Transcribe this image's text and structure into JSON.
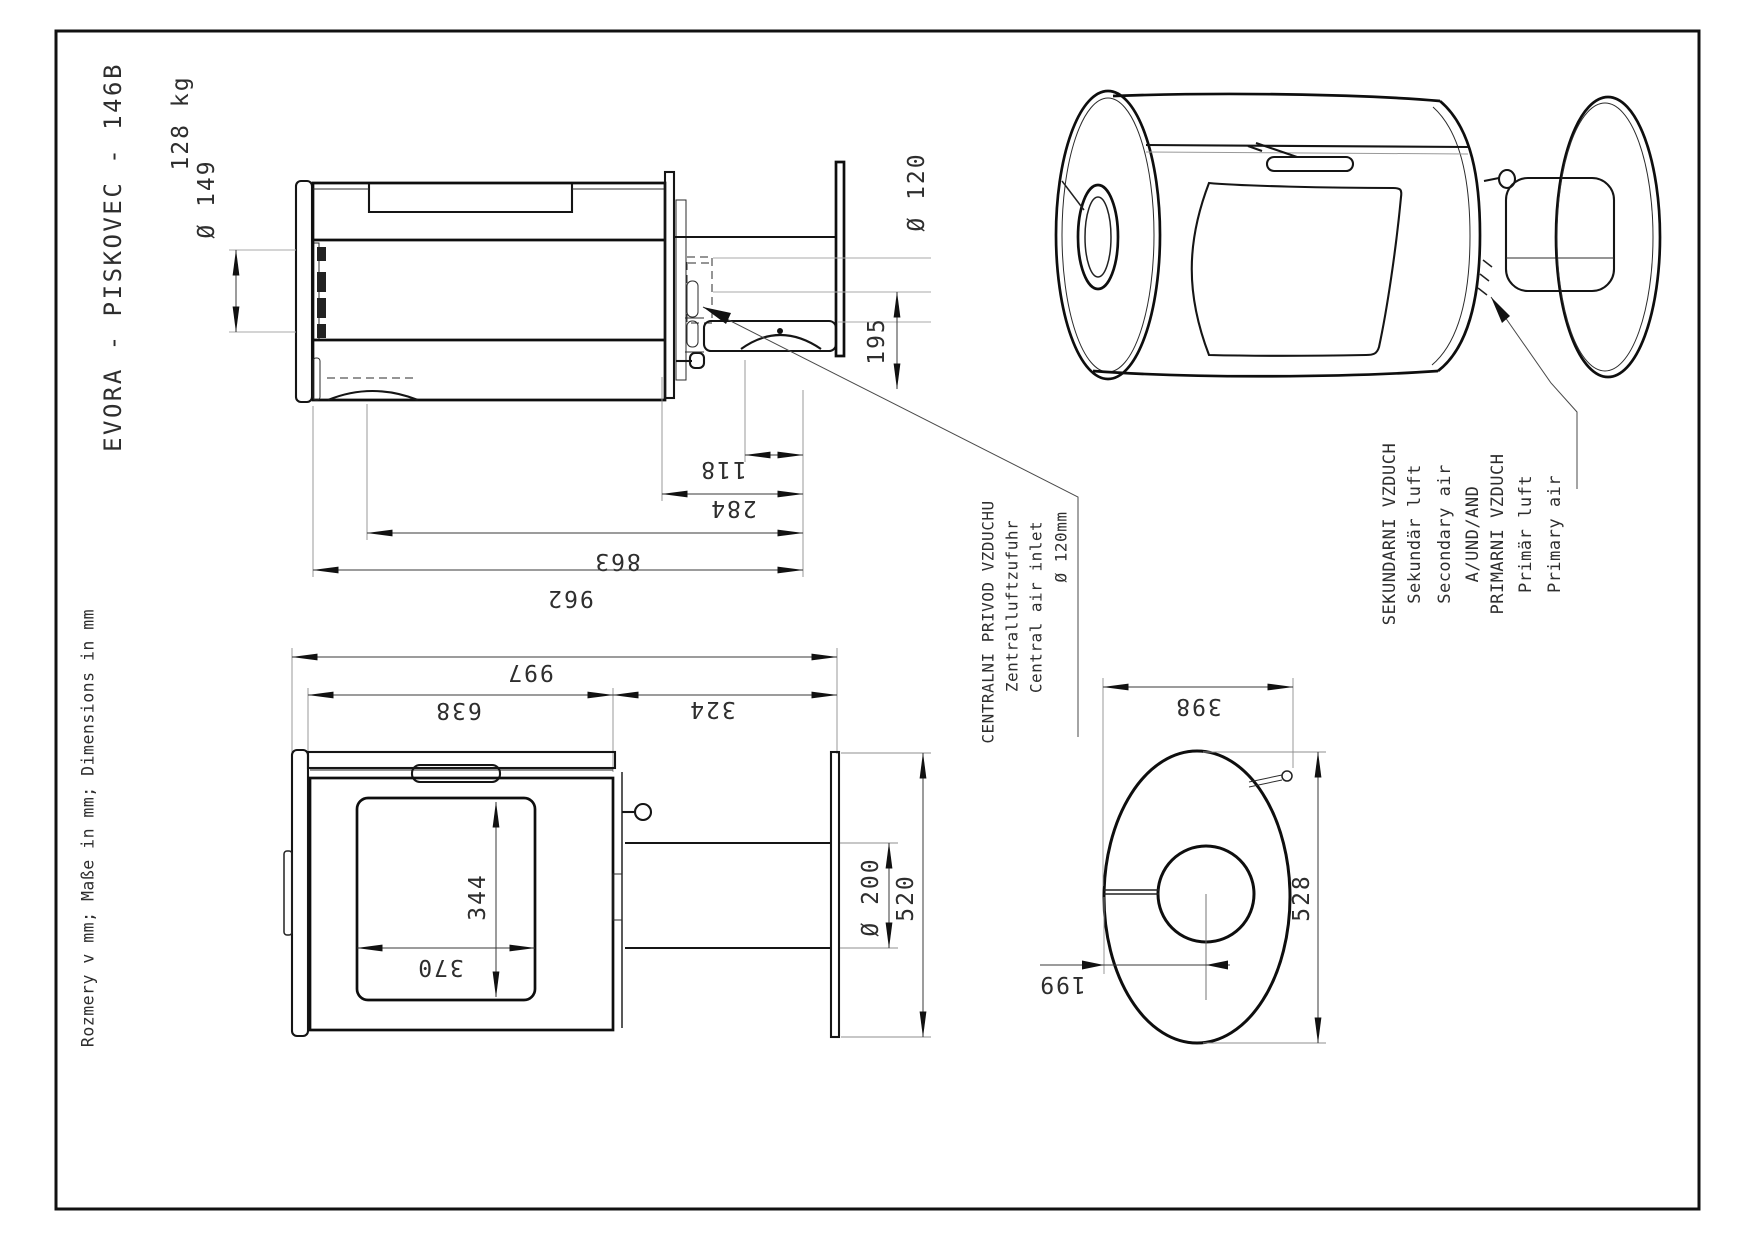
{
  "drawing": {
    "model": "EVORA - PISKOVEC - 146B",
    "weight": "128 kg",
    "units_note": "Rozmery v mm; Maße in mm; Dimensions in mm"
  },
  "callouts": {
    "central_air": [
      "CENTRALNI PRIVOD VZDUCHU",
      "Zentralluftzufuhr",
      "Central air inlet",
      "Ø 120mm"
    ],
    "air_supply": [
      "SEKUNDARNI VZDUCH",
      "Sekundär luft",
      "Secondary air",
      "A/UND/AND",
      "PRIMARNI VZDUCH",
      "Primär luft",
      "Primary air"
    ]
  },
  "dims": {
    "flue_diameter": "Ø 149",
    "inlet_diameter": "Ø 120",
    "inlet_height": "195",
    "inlet_to_wall": "118",
    "duct_depth": "284",
    "body_depth": "863",
    "total_depth": "962",
    "total_width": "997",
    "body_width": "638",
    "duct_width": "324",
    "glass_height": "344",
    "glass_width": "370",
    "duct_diameter": "Ø 200",
    "plate_height": "520",
    "plate_width": "398",
    "plate_diameter": "528",
    "hole_offset": "199"
  }
}
